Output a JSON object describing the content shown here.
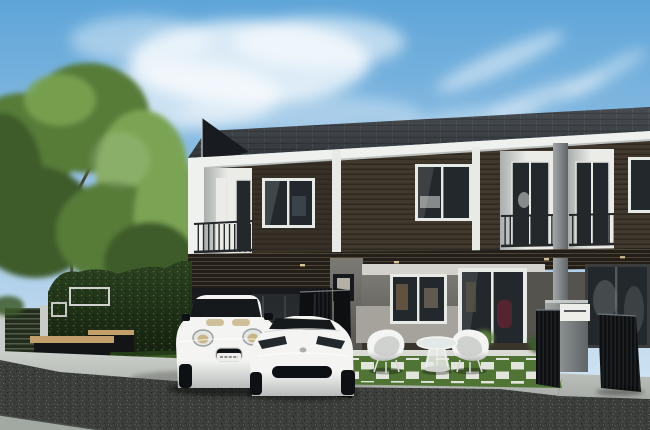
{
  "meta": {
    "description": "Photorealistic architectural rendering of a modern two-storey townhouse row with dark timber cladding, white fascia trim, balconies, a green hedge wall and tall tree on the left, a white Mini-style hatchback and a white sports coupe parked in the driveway, white wire patio chairs and table on a lawn with white paver squares, black metal gates, a grey mailbox pillar, a concrete sidewalk and a dark asphalt road in the foreground under a blue sky with wispy clouds",
    "width_px": 650,
    "height_px": 430
  },
  "objects": [
    "blue-sky",
    "wispy-clouds",
    "large-tree",
    "hedge-green-wall",
    "hedge-sign-frames",
    "timber-garden-bench",
    "slatted-fence-panel",
    "townhouse-row",
    "dark-roof-fin",
    "shingled-roof",
    "white-fascia",
    "timber-clad-second-floor",
    "balconies-with-railings",
    "upper-windows",
    "carport",
    "folding-black-gate",
    "ground-floor-window",
    "glass-entry-door",
    "patio-set-white-wire-chairs-and-table",
    "lawn-with-white-pavers",
    "shrubs",
    "mailbox-pillar",
    "black-entry-gates",
    "white-mini-hatchback",
    "white-sports-coupe",
    "concrete-driveway-sidewalk",
    "asphalt-road",
    "concrete-gutter"
  ],
  "palette": {
    "sky_top": "#5ea5d8",
    "sky_mid": "#a5c9e7",
    "sky_low": "#ddecf6",
    "cloud_white": "#ffffff",
    "roof_dark": "#474c50",
    "roof_deep": "#33383c",
    "fin_dark": "#181b1f",
    "fascia_white": "#eff1ee",
    "siding_dark": "#41392e",
    "siding_shadow": "#2e2921",
    "siding_slat": "#1c1813",
    "trim_white": "#e8eae6",
    "recess_light": "#ebece8",
    "recess_shadow": "#a9aeac",
    "railing_dark": "#24282a",
    "pillar_light": "#a2a7a8",
    "pillar_dark": "#5f6466",
    "interfloor_wood": "#5d4c38",
    "interfloor_dark": "#221e19",
    "glass_dark": "#23282c",
    "glass_reflection": "#76807f",
    "wall_light": "#a5a39c",
    "wall_mid": "#7c7a74",
    "wall_dark": "#55534d",
    "carport_dark": "#17191c",
    "soffit_light": "#d3d2cd",
    "porch_wood": "#3a352c",
    "curb_white": "#dadbd5",
    "lawn_green": "#507434",
    "lawn_dark": "#2f4c1e",
    "paver_white": "#e9ebe4",
    "hedge_green": "#2b4220",
    "hedge_dark": "#141f0e",
    "hedge_highlight": "#5d8440",
    "tree_dark": "#3c5c2a",
    "tree_mid": "#567c38",
    "tree_light": "#7aa452",
    "trunk_brown": "#4a4538",
    "bench_wood": "#c3a06b",
    "bench_dark": "#121416",
    "fence_post": "#c9cdc9",
    "fence_panel": "#222b1c",
    "concrete_light": "#ccd0ca",
    "concrete_mid": "#a8aca6",
    "road_dark": "#3b3e3b",
    "road_speckle": "#616662",
    "road_speckle_dark": "#242724",
    "gutter_light": "#a2a8a2",
    "car_body": "#f4f5f3",
    "car_shade": "#b7bbb9",
    "car_glass": "#16191c",
    "car_trim_dark": "#0e1114",
    "amber_light": "#c9b687",
    "bronze_rim": "#96713f",
    "gate_black": "#0d0f11",
    "gate_slat": "#2d3134",
    "mailbox_white": "#edeeea",
    "maroon_accent": "#5a2531",
    "downlight_warm": "#e6d6a4"
  }
}
